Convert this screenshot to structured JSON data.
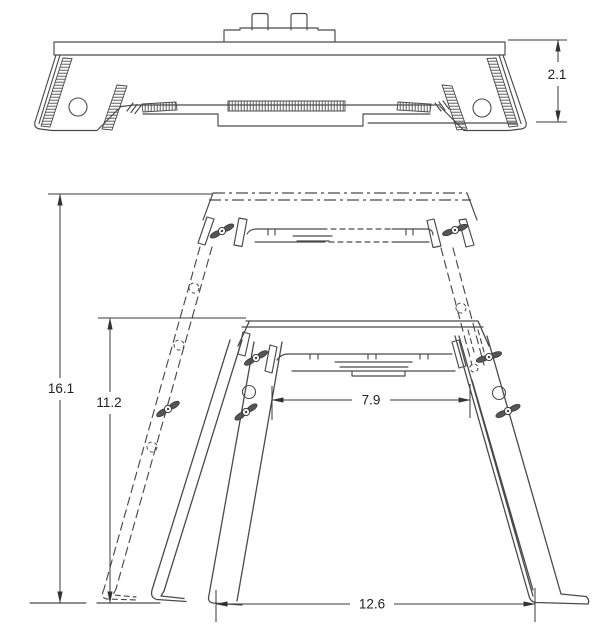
{
  "drawing": {
    "title": "folding-step-stool-dimensioned-drawing",
    "background_color": "#ffffff",
    "line_color": "#4a4a4a",
    "dimension_text_color": "#222222",
    "views": {
      "folded_profile": {
        "label": "folded-profile-view",
        "dims": {
          "folded_height": "2.1"
        }
      },
      "side_elevation": {
        "label": "side-elevation-view",
        "dims": {
          "extended_height": "16.1",
          "lowered_height": "11.2",
          "inner_leg_span": "7.9",
          "base_span": "12.6"
        }
      }
    }
  }
}
